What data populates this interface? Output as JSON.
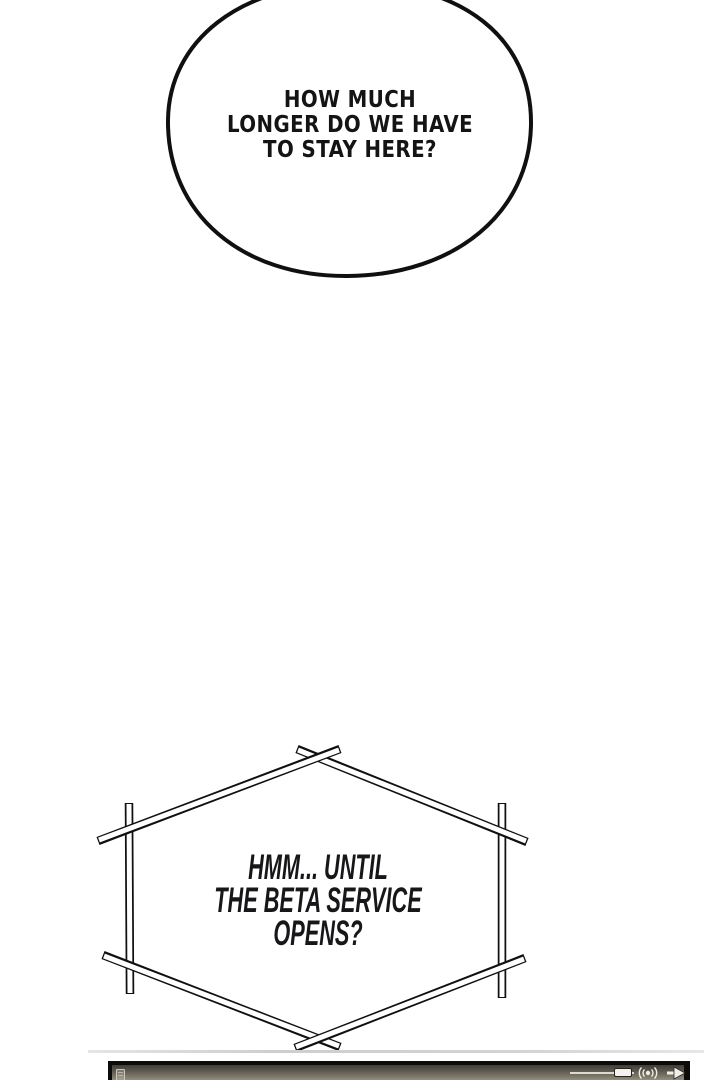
{
  "page": {
    "type": "comic-panel",
    "background_color": "#ffffff",
    "ink_color": "#141414"
  },
  "bubble1": {
    "shape": "rounded-oval",
    "lines": [
      "HOW MUCH",
      "LONGER DO WE HAVE",
      "TO STAY HERE?"
    ]
  },
  "bubble2": {
    "shape": "hexagon-crossed-beams",
    "lines": [
      "HMM... UNTIL",
      "THE BETA SERVICE",
      "OPENS?"
    ]
  },
  "player_bar": {
    "visible": "partially cut off at bottom edge",
    "icons": [
      "note-icon",
      "volume-slider",
      "speaker-icon",
      "next-arrow-icon"
    ],
    "colors": {
      "border": "#0b0b09",
      "gradient_top": "#403d35",
      "gradient_bottom": "#948e80",
      "controls": "#f3f2ee"
    }
  }
}
